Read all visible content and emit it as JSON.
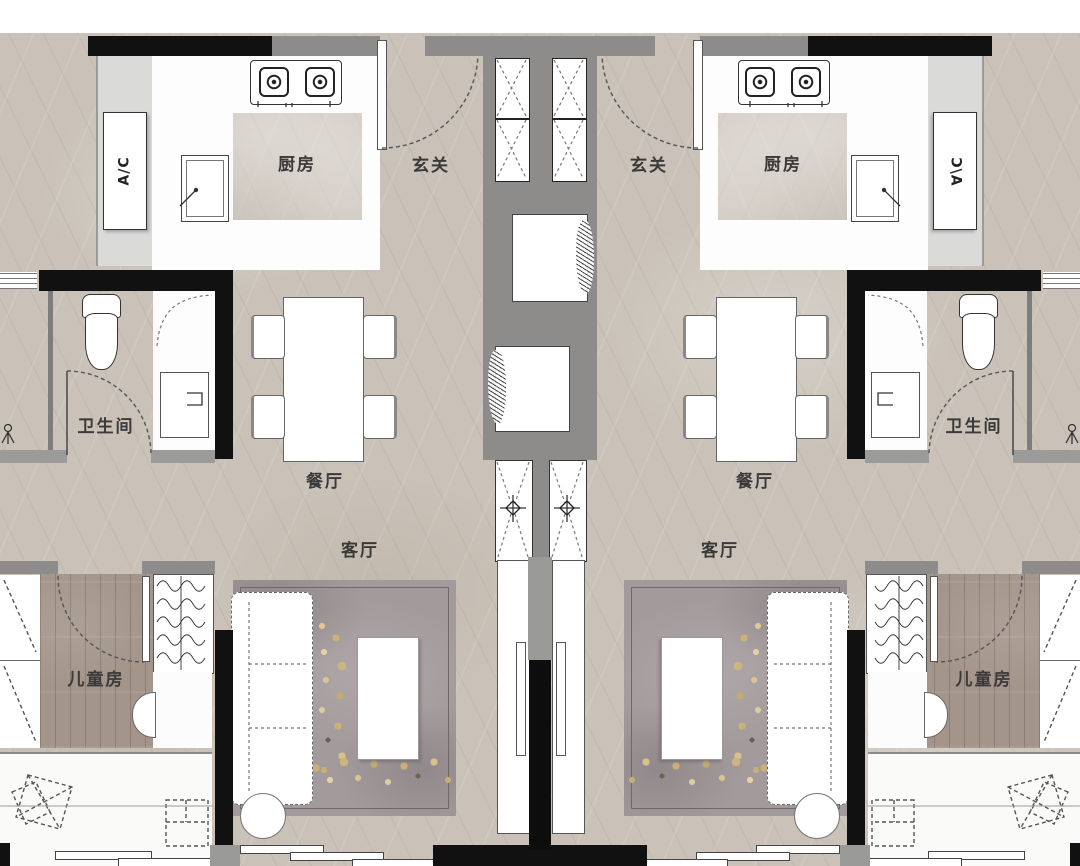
{
  "rooms": {
    "kitchen": {
      "label": "厨房"
    },
    "foyer": {
      "label": "玄关"
    },
    "bathroom": {
      "label": "卫生间"
    },
    "dining": {
      "label": "餐厅"
    },
    "living": {
      "label": "客厅"
    },
    "kids_room": {
      "label": "儿童房"
    },
    "ac_platform": {
      "label": "A/C"
    }
  },
  "layout": {
    "units": [
      "left-unit",
      "right-unit-mirrored"
    ],
    "core_features": [
      "elevator-shaft-x2",
      "service-niche-x2",
      "vent-shaft-with-fan-x2",
      "party-wall"
    ]
  },
  "fixtures": [
    "stove-icon",
    "sink-icon",
    "toilet-icon",
    "shower-tray-icon",
    "shower-head-icon",
    "elevator-x-icon",
    "vent-fan-icon",
    "dining-table",
    "dining-chair",
    "sofa",
    "coffee-table",
    "side-table",
    "wardrobe-hangers-icon",
    "sliding-door",
    "door-swing-arc"
  ],
  "colors": {
    "floor_marble": "#cac2b8",
    "wall_black": "#111111",
    "wall_gray": "#8d8c8a",
    "platform_gray": "#dadad8",
    "wood_floor": "#a3958a",
    "rug": "#a39a9c",
    "flower_gold": "#d2bc85",
    "room_white": "#fdfdfd"
  }
}
